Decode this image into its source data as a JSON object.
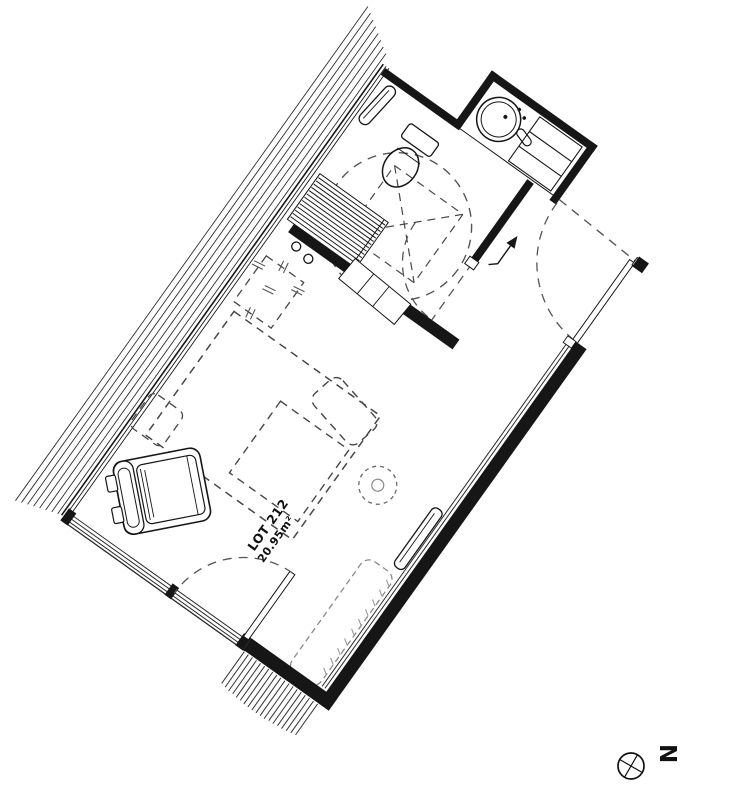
{
  "colors": {
    "background": "#ffffff",
    "ink": "#161616",
    "dashed_furniture": "#474747",
    "dashed_swing": "#555555"
  },
  "plan": {
    "lot_label": "LOT 212",
    "area_label": "20.95m²"
  },
  "compass": {
    "north_label": "N"
  }
}
